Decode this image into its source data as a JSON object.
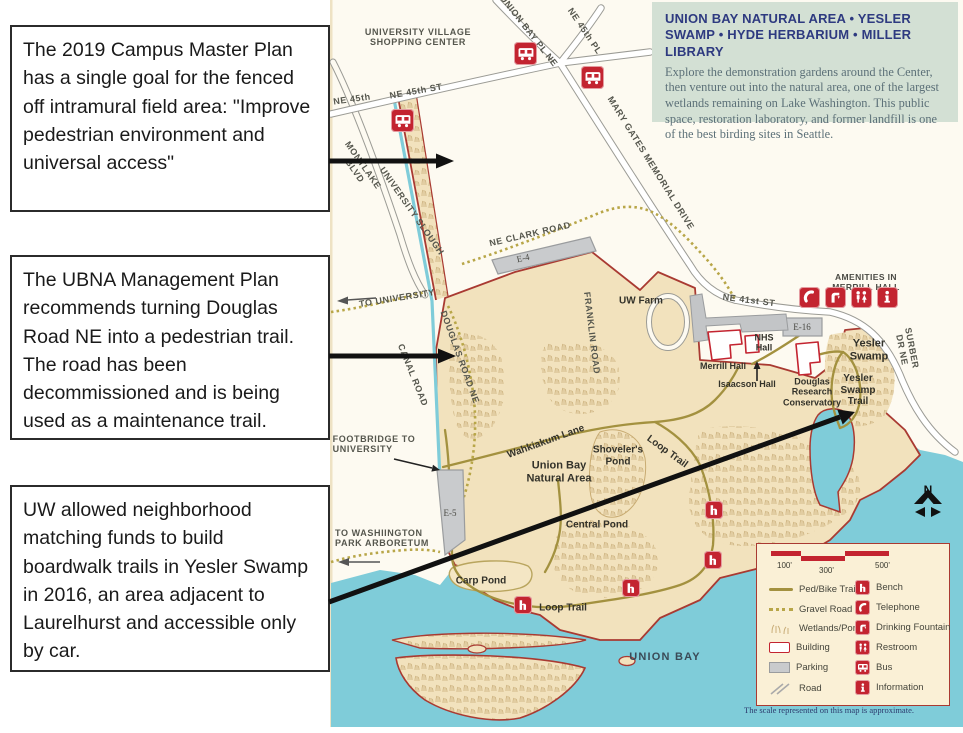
{
  "annotations": {
    "box1": "The 2019 Campus Master Plan has a single goal for the fenced off intramural field area: \"Improve pedestrian environment and universal access\"",
    "box2": "The UBNA Management Plan recommends turning Douglas Road NE into a pedestrian trail. The road has been decommissioned and is being used as a maintenance trail.",
    "box3": "UW allowed neighborhood matching funds to build boardwalk trails in Yesler Swamp in 2016, an area adjacent to Laurelhurst and accessible only by car."
  },
  "info_box": {
    "title": "UNION BAY NATURAL AREA • YESLER SWAMP • HYDE HERBARIUM • MILLER LIBRARY",
    "body": "Explore the demonstration gardens around the Center, then venture out into the natural area, one of the largest wetlands remaining on Lake Washington. This public space, restoration laboratory, and former landfill is one of the best birding sites in Seattle."
  },
  "map": {
    "roads": {
      "university_village": "UNIVERSITY VILLAGE\nSHOPPING CENTER",
      "union_bay_pl": "UNION BAY PL NE",
      "ne_45th_pl": "NE 45th PL",
      "ne_45th_st": "NE 45th ST",
      "ne_45th": "NE 45th",
      "mary_gates": "MARY GATES MEMORIAL DRIVE",
      "montlake": "MONTLAKE\nBLVD",
      "university_slough": "UNIVERSITY SLOUGH",
      "ne_clark": "NE CLARK ROAD",
      "canal": "CANAL ROAD",
      "douglas": "DOUGLAS ROAD NE",
      "franklin": "FRANKLIN ROAD",
      "ne_41st": "NE 41st ST",
      "surber": "SURBER DR NE"
    },
    "directions": {
      "to_university": "TO UNIVERSITY",
      "footbridge": "FOOTBRIDGE TO\nUNIVERSITY",
      "to_arboretum": "TO WASHIINGTON\nPARK ARBORETUM"
    },
    "places": {
      "uw_farm": "UW Farm",
      "nhs_hall": "NHS\nHall",
      "merrill_hall": "Merrill Hall",
      "isaacson": "Isaacson Hall",
      "douglas_research": "Douglas\nResearch\nConservatory",
      "yesler_swamp": "Yesler\nSwamp",
      "yesler_swamp_trail": "Yesler\nSwamp\nTrail",
      "wahkiakum": "Wahkiakum Lane",
      "shovelers": "Shoveler's\nPond",
      "loop_trail_ne": "Loop Trail",
      "ubna": "Union Bay\nNatural Area",
      "central_pond": "Central Pond",
      "carp_pond": "Carp Pond",
      "loop_trail_s": "Loop Trail",
      "union_bay": "UNION BAY"
    },
    "parking_labels": {
      "e4": "E-4",
      "e5": "E-5",
      "e16": "E-16"
    },
    "amenities_title": "AMENITIES IN MERRILL HALL",
    "compass": "N",
    "footer": "The scale represented on this map is approximate."
  },
  "legend": {
    "scale_labels": [
      "100'",
      "300'",
      "500'"
    ],
    "left": [
      "Ped/Bike Trail",
      "Gravel Road",
      "Wetlands/Ponds",
      "Building",
      "Parking",
      "Road"
    ],
    "right": [
      "Bench",
      "Telephone",
      "Drinking Fountain",
      "Restroom",
      "Bus",
      "Information"
    ]
  },
  "colors": {
    "accent": "#c32430",
    "boundary": "#a93a32",
    "water": "#7fccd9",
    "land": "#f2e2bd",
    "olive": "#a3913f",
    "gravel": "#b8a648",
    "infobg": "#d3e0d4",
    "navy": "#2e3a80",
    "legendbg": "#faf0d6"
  }
}
